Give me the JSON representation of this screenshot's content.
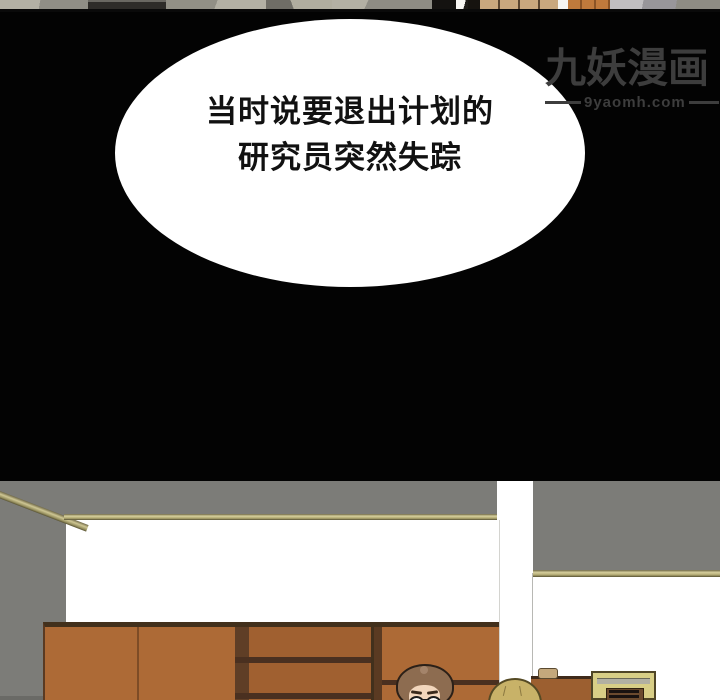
{
  "speech_panel": {
    "bg_color": "#030303",
    "bubble": {
      "fill": "#ffffff",
      "text_color": "#111111",
      "line1": "当时说要退出计划的",
      "line2": "研究员突然失踪"
    },
    "watermark": {
      "title": "九妖漫画",
      "url": "9yaomh.com",
      "color": "#3d3d3d"
    }
  },
  "room_panel": {
    "wall_gray": "#7c7c78",
    "molding_khaki": "#b6ae74",
    "wall_white": "#ffffff",
    "bookshelf_face": "#ad6a36",
    "bookshelf_edge": "#42301c",
    "shelf_interior": "#5f3e26",
    "right_cabinet": "#9c5f30",
    "radio_frame": "#d8ce86",
    "character1_hair": "#8d6c50",
    "character1_skin": "#f2d6bc",
    "character2_hair": "#c8b268"
  },
  "previous_panel": {
    "floor_gray": "#8e8c84",
    "floor_light": "#b3b0a4",
    "wood_tan": "#c9a87e",
    "wood_orange": "#bf7a3c"
  }
}
